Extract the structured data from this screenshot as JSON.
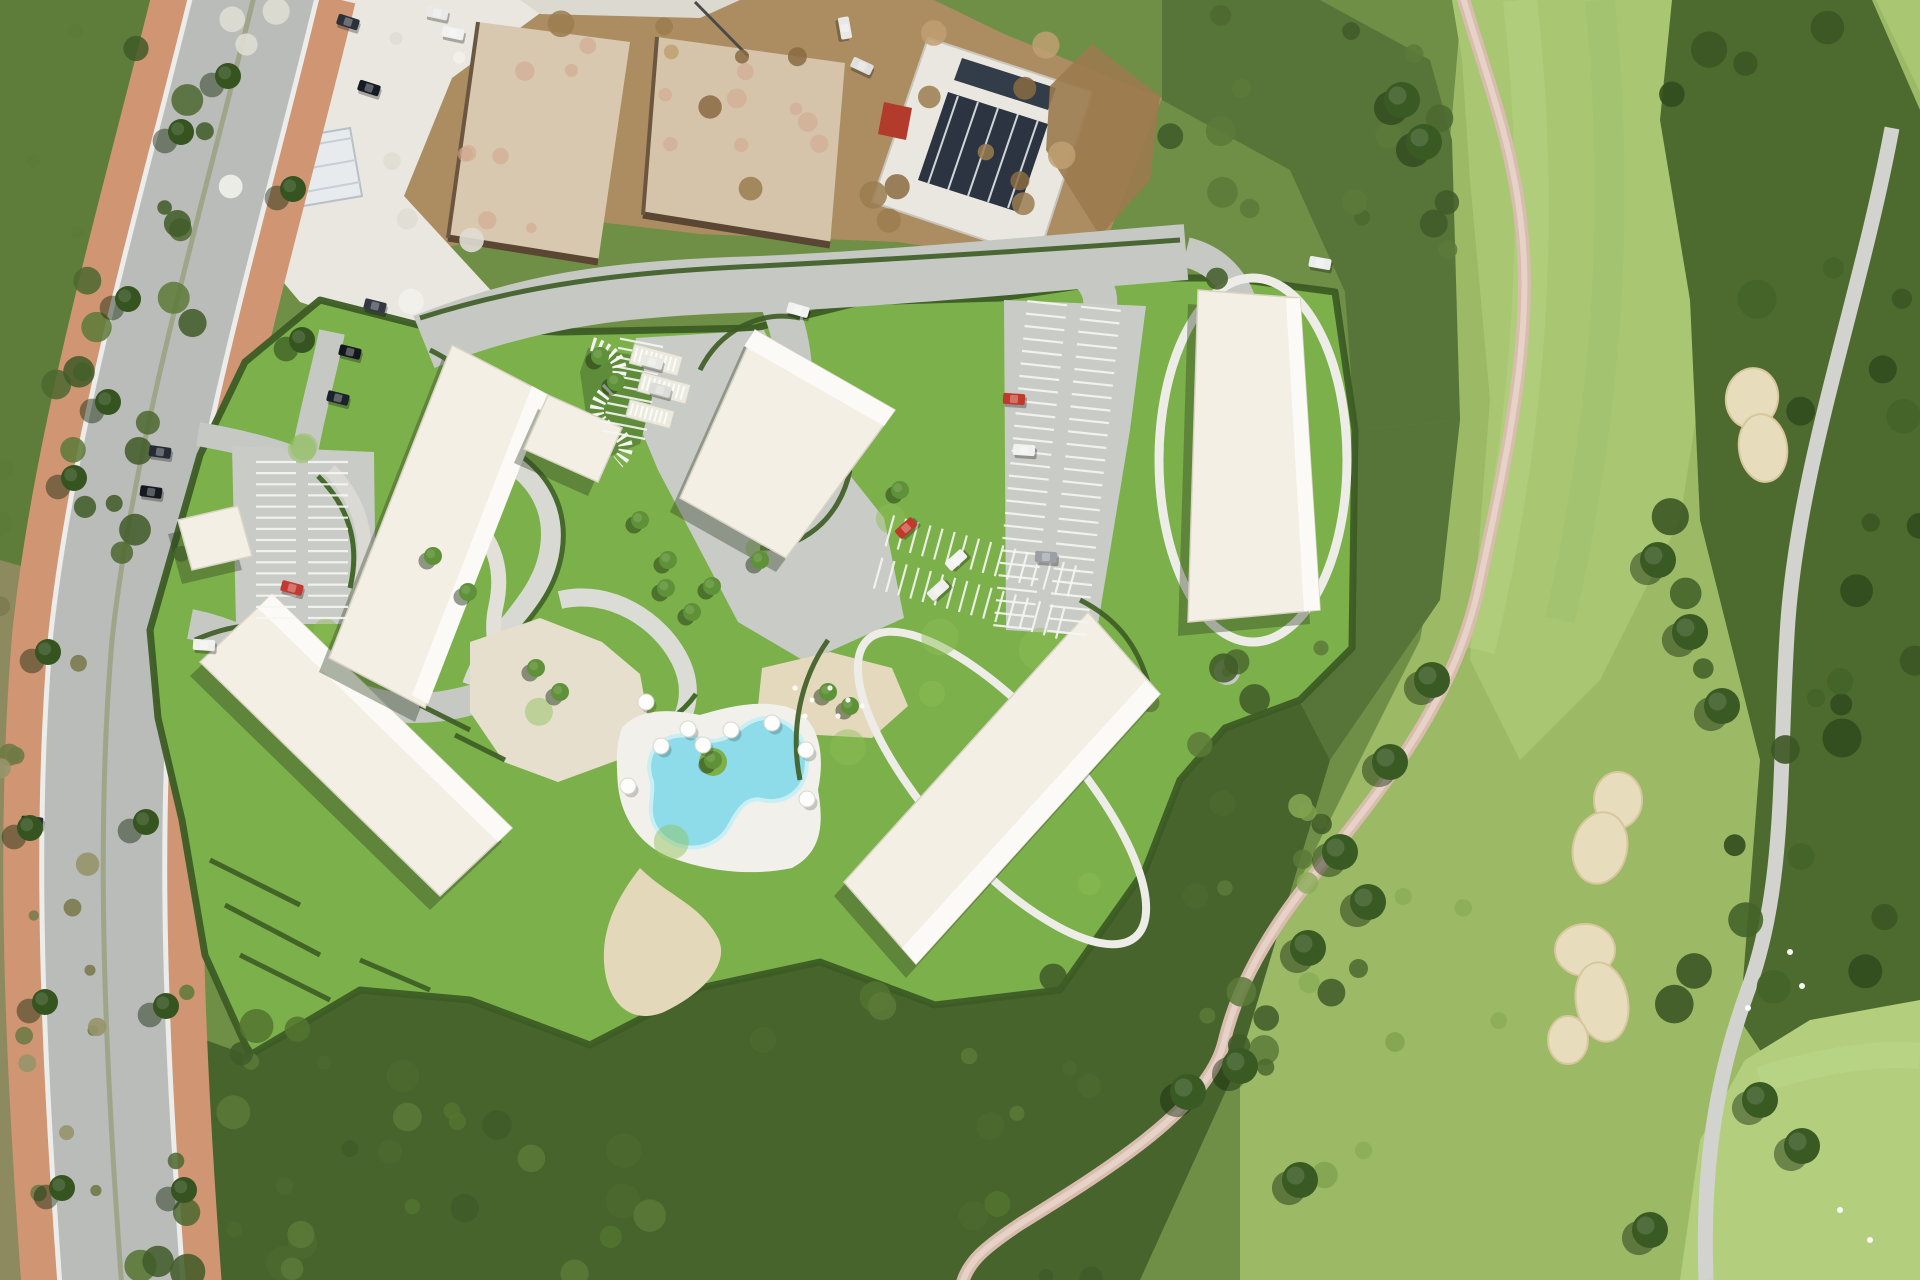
{
  "meta": {
    "kind": "aerial-render",
    "description": "Top-down aerial render of a residential development with five cream apartment blocks, landscaped serpentine gardens, kidney-shaped pool with parasols, parking lots, a divided avenue with terracotta sidewalks on the left, construction slabs at top, and a golf course with sand bunkers on the right."
  },
  "palette": {
    "rough": "#6f8f46",
    "scrub": "#5e7d3a",
    "scrub_dark": "#46642c",
    "dark_band": "#4d6b2f",
    "fairway": "#a9c773",
    "fairway_light": "#b3cf7e",
    "lawn": "#7cb04a",
    "hedge": "#3c5c24",
    "tree": "#35541f",
    "tree_bright": "#5f9138",
    "road": "#b9bcb8",
    "road_light": "#c6c8c3",
    "curb": "#ececea",
    "sidewalk": "#d09673",
    "apron": "#c9cbc7",
    "path_white": "#e2e0d9",
    "path_beige": "#e6dfce",
    "sand": "#e4d8ba",
    "bunker": "#e7dcbc",
    "pool": "#8edce9",
    "deck": "#f1f0ea",
    "building": "#f3efe5",
    "building_accent": "#fbfaf6",
    "shadow": "rgba(45,62,34,0.38)",
    "dirt": "#ac8d61",
    "gravel": "#e9e7e0",
    "slab": "#d8c8b0",
    "solar_dark": "#2b3440",
    "container_red": "#b23b2c",
    "pink_path": "#d8bcae",
    "stripe": "#f6f6f3"
  },
  "layers": {
    "texture_regions": [
      {
        "box": [
          0,
          0,
          210,
          560
        ],
        "count": 26,
        "rmin": 6,
        "rmax": 16,
        "colors": [
          "#4c682f",
          "#3f5a28",
          "#5c7a38"
        ],
        "op": 0.85,
        "seed": 11
      },
      {
        "box": [
          140,
          960,
          1000,
          320
        ],
        "count": 46,
        "rmin": 7,
        "rmax": 18,
        "colors": [
          "#4c682f",
          "#3f5a28",
          "#54742f",
          "#5c7a38"
        ],
        "op": 0.85,
        "seed": 23
      },
      {
        "box": [
          1150,
          640,
          210,
          430
        ],
        "count": 20,
        "rmin": 7,
        "rmax": 16,
        "colors": [
          "#4c682f",
          "#3f5a28",
          "#5c7a38"
        ],
        "op": 0.85,
        "seed": 37
      },
      {
        "box": [
          1170,
          0,
          280,
          280
        ],
        "count": 16,
        "rmin": 7,
        "rmax": 16,
        "colors": [
          "#4c682f",
          "#3f5a28",
          "#5c7a38"
        ],
        "op": 0.85,
        "seed": 41
      },
      {
        "box": [
          1670,
          10,
          250,
          1000
        ],
        "count": 30,
        "rmin": 9,
        "rmax": 20,
        "colors": [
          "#3c5723",
          "#324c1e",
          "#45642a"
        ],
        "op": 0.9,
        "seed": 53
      },
      {
        "box": [
          1300,
          720,
          200,
          460
        ],
        "count": 10,
        "rmin": 8,
        "rmax": 14,
        "colors": [
          "#8bad58",
          "#7fa14f"
        ],
        "op": 0.8,
        "seed": 61
      },
      {
        "box": [
          0,
          580,
          100,
          700
        ],
        "count": 16,
        "rmin": 5,
        "rmax": 12,
        "colors": [
          "#7d7a50",
          "#6e7a45",
          "#97936a"
        ],
        "op": 0.9,
        "seed": 71
      },
      {
        "box": [
          560,
          10,
          560,
          240
        ],
        "count": 18,
        "rmin": 6,
        "rmax": 14,
        "colors": [
          "#9a7c50",
          "#8a6b42",
          "#bfa072"
        ],
        "op": 0.85,
        "seed": 83
      },
      {
        "box": [
          465,
          35,
          150,
          210
        ],
        "count": 8,
        "rmin": 5,
        "rmax": 10,
        "colors": [
          "#d2a98d"
        ],
        "op": 0.6,
        "seed": 89
      },
      {
        "box": [
          665,
          50,
          160,
          180
        ],
        "count": 8,
        "rmin": 5,
        "rmax": 10,
        "colors": [
          "#d2a98d"
        ],
        "op": 0.6,
        "seed": 97
      },
      {
        "box": [
          230,
          10,
          300,
          300
        ],
        "count": 10,
        "rmin": 6,
        "rmax": 14,
        "colors": [
          "#f2f1ec",
          "#dfddd4"
        ],
        "op": 0.9,
        "seed": 101
      },
      {
        "box": [
          300,
          400,
          800,
          500
        ],
        "count": 14,
        "rmin": 10,
        "rmax": 22,
        "colors": [
          "#8cbe57"
        ],
        "op": 0.45,
        "seed": 107
      }
    ],
    "buildings": [
      {
        "name": "block-a-annex",
        "poly": [
          [
            178,
            520
          ],
          [
            238,
            506
          ],
          [
            252,
            556
          ],
          [
            192,
            570
          ]
        ]
      },
      {
        "name": "block-a",
        "poly": [
          [
            200,
            662
          ],
          [
            272,
            594
          ],
          [
            512,
            828
          ],
          [
            440,
            896
          ]
        ],
        "accent": [
          [
            272,
            594
          ],
          [
            512,
            828
          ],
          [
            498,
            842
          ],
          [
            258,
            608
          ]
        ]
      },
      {
        "name": "block-b",
        "poly": [
          [
            452,
            345
          ],
          [
            548,
            395
          ],
          [
            425,
            708
          ],
          [
            329,
            658
          ]
        ],
        "accent": [
          [
            548,
            395
          ],
          [
            428,
            704
          ],
          [
            412,
            695
          ],
          [
            532,
            386
          ]
        ]
      },
      {
        "name": "block-b-wing",
        "poly": [
          [
            548,
            395
          ],
          [
            622,
            428
          ],
          [
            598,
            482
          ],
          [
            524,
            449
          ]
        ]
      },
      {
        "name": "block-c",
        "poly": [
          [
            755,
            330
          ],
          [
            895,
            410
          ],
          [
            786,
            558
          ],
          [
            680,
            498
          ]
        ],
        "accent": [
          [
            755,
            330
          ],
          [
            895,
            410
          ],
          [
            884,
            426
          ],
          [
            744,
            346
          ]
        ]
      },
      {
        "name": "block-d",
        "poly": [
          [
            1198,
            290
          ],
          [
            1300,
            298
          ],
          [
            1320,
            610
          ],
          [
            1188,
            622
          ]
        ],
        "accent": [
          [
            1300,
            298
          ],
          [
            1320,
            610
          ],
          [
            1304,
            611
          ],
          [
            1286,
            299
          ]
        ]
      },
      {
        "name": "block-e",
        "poly": [
          [
            1088,
            612
          ],
          [
            1160,
            694
          ],
          [
            916,
            964
          ],
          [
            844,
            882
          ]
        ],
        "accent": [
          [
            1160,
            694
          ],
          [
            916,
            964
          ],
          [
            902,
            948
          ],
          [
            1146,
            680
          ]
        ]
      }
    ],
    "parking_stripes": [
      {
        "x1": 302,
        "y1": 462,
        "x2": 302,
        "y2": 618,
        "offsets": [
          -26,
          26
        ],
        "count": 15,
        "half": 20
      },
      {
        "x1": 668,
        "y1": 348,
        "x2": 650,
        "y2": 440,
        "offsets": [
          27
        ],
        "count": 11,
        "half": 22
      },
      {
        "x1": 1074,
        "y1": 306,
        "x2": 1040,
        "y2": 630,
        "offsets": [
          -27,
          27
        ],
        "count": 27,
        "half": 20
      },
      {
        "x1": 884,
        "y1": 552,
        "x2": 1066,
        "y2": 602,
        "offsets": [
          -22,
          22
        ],
        "count": 16,
        "half": 16
      }
    ],
    "carports": [
      {
        "x": 656,
        "y": 360,
        "w": 50,
        "h": 20,
        "rot": 15
      },
      {
        "x": 664,
        "y": 388,
        "w": 50,
        "h": 20,
        "rot": 15
      },
      {
        "x": 650,
        "y": 414,
        "w": 46,
        "h": 18,
        "rot": 15
      }
    ],
    "tree_groups": [
      {
        "name": "roadside-trees",
        "r": 13,
        "color": "#35541f",
        "shadow": [
          -16,
          9
        ],
        "pts": [
          [
            181,
            132
          ],
          [
            128,
            299
          ],
          [
            108,
            402
          ],
          [
            74,
            478
          ],
          [
            293,
            189
          ],
          [
            48,
            652
          ],
          [
            30,
            828
          ],
          [
            146,
            822
          ],
          [
            45,
            1002
          ],
          [
            166,
            1006
          ],
          [
            62,
            1188
          ],
          [
            184,
            1190
          ],
          [
            228,
            76
          ],
          [
            302,
            340
          ]
        ]
      },
      {
        "name": "garden-trees",
        "r": 9,
        "color": "#5f9138",
        "shadow": [
          -6,
          5
        ],
        "pts": [
          [
            666,
            588
          ],
          [
            692,
            612
          ],
          [
            712,
            586
          ],
          [
            536,
            668
          ],
          [
            560,
            692
          ],
          [
            433,
            556
          ],
          [
            468,
            592
          ],
          [
            640,
            520
          ],
          [
            600,
            356
          ],
          [
            616,
            382
          ],
          [
            760,
            560
          ],
          [
            828,
            692
          ],
          [
            850,
            706
          ],
          [
            900,
            490
          ],
          [
            668,
            560
          ],
          [
            713,
            760
          ]
        ]
      },
      {
        "name": "golf-trees",
        "r": 18,
        "color": "#3a5a24",
        "shadow": [
          -11,
          8
        ],
        "pts": [
          [
            1402,
            100
          ],
          [
            1424,
            142
          ],
          [
            1340,
            852
          ],
          [
            1368,
            902
          ],
          [
            1308,
            948
          ],
          [
            1390,
            762
          ],
          [
            1432,
            680
          ],
          [
            1658,
            560
          ],
          [
            1690,
            632
          ],
          [
            1722,
            706
          ],
          [
            1760,
            1100
          ],
          [
            1802,
            1146
          ],
          [
            1188,
            1092
          ],
          [
            1240,
            1066
          ],
          [
            1300,
            1180
          ],
          [
            1650,
            1230
          ]
        ]
      }
    ],
    "vehicles": [
      {
        "x": 348,
        "y": 22,
        "rot": 18,
        "color": "#2b313b"
      },
      {
        "x": 369,
        "y": 88,
        "rot": 18,
        "color": "#171c24"
      },
      {
        "x": 375,
        "y": 306,
        "rot": 14,
        "color": "#323944"
      },
      {
        "x": 350,
        "y": 352,
        "rot": 14,
        "color": "#12161d"
      },
      {
        "x": 338,
        "y": 398,
        "rot": 14,
        "color": "#1c222b"
      },
      {
        "x": 437,
        "y": 13,
        "rot": 12,
        "color": "#e9e9e7"
      },
      {
        "x": 453,
        "y": 33,
        "rot": 12,
        "color": "#f1f1ef"
      },
      {
        "x": 845,
        "y": 28,
        "rot": 80,
        "color": "#e8e8e6"
      },
      {
        "x": 862,
        "y": 66,
        "rot": 25,
        "color": "#dfe0de"
      },
      {
        "x": 160,
        "y": 452,
        "rot": 8,
        "color": "#262c35"
      },
      {
        "x": 151,
        "y": 492,
        "rot": 8,
        "color": "#14191f"
      },
      {
        "x": 204,
        "y": 645,
        "rot": 4,
        "color": "#f0f0ee"
      },
      {
        "x": 32,
        "y": 822,
        "rot": 6,
        "color": "#272d36"
      },
      {
        "x": 798,
        "y": 310,
        "rot": 16,
        "color": "#f2f2f0"
      },
      {
        "x": 1320,
        "y": 263,
        "rot": 10,
        "color": "#eceded"
      },
      {
        "x": 292,
        "y": 588,
        "rot": 15,
        "color": "#c33a30"
      },
      {
        "x": 906,
        "y": 528,
        "rot": -42,
        "color": "#c0392b"
      },
      {
        "x": 956,
        "y": 560,
        "rot": -42,
        "color": "#f3f3f1"
      },
      {
        "x": 938,
        "y": 590,
        "rot": -42,
        "color": "#eeeeec"
      },
      {
        "x": 1014,
        "y": 399,
        "rot": 4,
        "color": "#c0392b"
      },
      {
        "x": 1024,
        "y": 450,
        "rot": 4,
        "color": "#f1f1ef"
      },
      {
        "x": 1046,
        "y": 557,
        "rot": 4,
        "color": "#9aa0a6"
      },
      {
        "x": 652,
        "y": 362,
        "rot": 15,
        "color": "#e8e8e4"
      },
      {
        "x": 660,
        "y": 390,
        "rot": 15,
        "color": "#dcdcd8"
      }
    ],
    "umbrellas": [
      [
        688,
        729
      ],
      [
        731,
        730
      ],
      [
        772,
        723
      ],
      [
        806,
        750
      ],
      [
        661,
        746
      ],
      [
        628,
        786
      ],
      [
        807,
        799
      ],
      [
        646,
        702
      ],
      [
        703,
        745
      ]
    ],
    "bunkers": [
      {
        "cx": 1752,
        "cy": 398,
        "rx": 26,
        "ry": 30,
        "rot": 10
      },
      {
        "cx": 1763,
        "cy": 448,
        "rx": 24,
        "ry": 34,
        "rot": -8
      },
      {
        "cx": 1618,
        "cy": 800,
        "rx": 24,
        "ry": 28,
        "rot": 0
      },
      {
        "cx": 1600,
        "cy": 848,
        "rx": 27,
        "ry": 36,
        "rot": 12
      },
      {
        "cx": 1585,
        "cy": 950,
        "rx": 30,
        "ry": 26,
        "rot": 0
      },
      {
        "cx": 1602,
        "cy": 1002,
        "rx": 26,
        "ry": 40,
        "rot": -10
      },
      {
        "cx": 1568,
        "cy": 1040,
        "rx": 20,
        "ry": 24,
        "rot": 0
      }
    ],
    "white_specks": [
      [
        1790,
        952
      ],
      [
        1802,
        986
      ],
      [
        1748,
        1008
      ],
      [
        1840,
        1210
      ],
      [
        1870,
        1240
      ]
    ],
    "play_dots": [
      [
        795,
        688
      ],
      [
        812,
        700
      ],
      [
        830,
        688
      ],
      [
        848,
        700
      ],
      [
        805,
        716
      ],
      [
        838,
        716
      ],
      [
        862,
        706
      ]
    ]
  }
}
